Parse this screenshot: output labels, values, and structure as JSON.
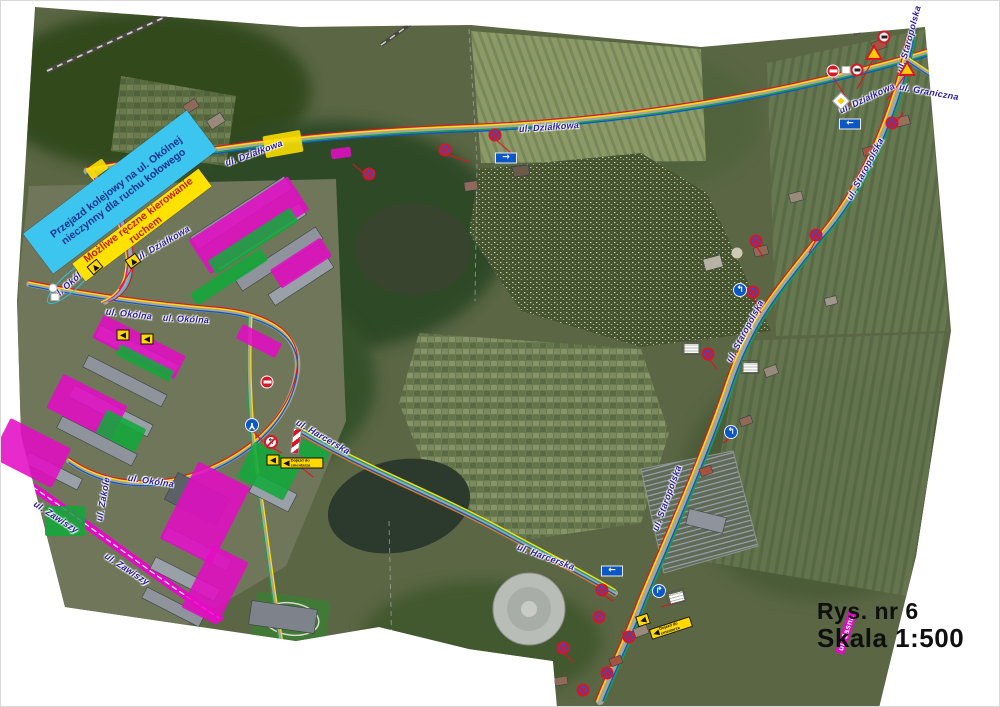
{
  "title_block": {
    "line1": "Rys. nr 6",
    "line2": "Skala 1:500"
  },
  "colors": {
    "magenta": "#e20cc4",
    "green": "#11a83a",
    "yellow": "#ffe000",
    "callout_cyan": "#3cc6ef",
    "callout_yellow": "#ffe200",
    "label_blue": "#2a1b9e",
    "sign_red": "#d81626",
    "sign_blue": "#0b57c8",
    "route_red": "#e01420"
  },
  "callouts": [
    {
      "text": "Przejazd kolejowy na ul. Okólnej nieczynny dla ruchu kołowego",
      "x": 119,
      "y": 191,
      "w": 205,
      "h": 50,
      "rot": -37,
      "bg": "#3cc6ef",
      "color": "#14328c"
    },
    {
      "text": "Możliwe ręczne kierowanie ruchem",
      "x": 141,
      "y": 224,
      "w": 158,
      "h": 22,
      "rot": -37,
      "bg": "#ffe200",
      "color": "#c41e10"
    }
  ],
  "street_labels": [
    {
      "text": "ul. Działkowa",
      "x": 253,
      "y": 152,
      "rot": -20
    },
    {
      "text": "ul. Działkowa",
      "x": 548,
      "y": 126,
      "rot": -4
    },
    {
      "text": "ul. Działkowa",
      "x": 866,
      "y": 97,
      "rot": -25
    },
    {
      "text": "ul. Działkowa",
      "x": 162,
      "y": 242,
      "rot": -30
    },
    {
      "text": "ul. Graniczna",
      "x": 928,
      "y": 91,
      "rot": 10
    },
    {
      "text": "ul. Staropolska",
      "x": 908,
      "y": 38,
      "rot": -75
    },
    {
      "text": "ul. Staropolska",
      "x": 864,
      "y": 168,
      "rot": -62
    },
    {
      "text": "ul. Staropolska",
      "x": 744,
      "y": 330,
      "rot": -62
    },
    {
      "text": "ul. Staropolska",
      "x": 666,
      "y": 497,
      "rot": -70
    },
    {
      "text": "ul. Harcerska",
      "x": 545,
      "y": 556,
      "rot": 20
    },
    {
      "text": "ul. Harcerska",
      "x": 322,
      "y": 436,
      "rot": 30
    },
    {
      "text": "ul. Okólna",
      "x": 128,
      "y": 313,
      "rot": 6
    },
    {
      "text": "ul. Okólna",
      "x": 185,
      "y": 318,
      "rot": 3
    },
    {
      "text": "ul. Okólna",
      "x": 150,
      "y": 480,
      "rot": 8
    },
    {
      "text": "ul. Okólna",
      "x": 70,
      "y": 281,
      "rot": -42,
      "variant": "circled"
    },
    {
      "text": "ul. Zawiszy",
      "x": 55,
      "y": 516,
      "rot": 33
    },
    {
      "text": "ul. Zawiszy",
      "x": 126,
      "y": 568,
      "rot": 33
    },
    {
      "text": "ul. Zakole",
      "x": 102,
      "y": 498,
      "rot": -80
    },
    {
      "text": "ul. Jasna",
      "x": 845,
      "y": 632,
      "rot": -72,
      "variant": "boxed"
    }
  ],
  "zones": [
    {
      "color": "magenta",
      "x": 248,
      "y": 224,
      "w": 118,
      "h": 40,
      "rot": -33
    },
    {
      "color": "magenta",
      "x": 300,
      "y": 262,
      "w": 60,
      "h": 22,
      "rot": -33
    },
    {
      "color": "magenta",
      "x": 138,
      "y": 346,
      "w": 92,
      "h": 26,
      "rot": 27
    },
    {
      "color": "magenta",
      "x": 86,
      "y": 406,
      "w": 72,
      "h": 38,
      "rot": 27
    },
    {
      "color": "magenta",
      "x": 30,
      "y": 452,
      "w": 68,
      "h": 44,
      "rot": 27
    },
    {
      "color": "magenta",
      "x": 204,
      "y": 512,
      "w": 58,
      "h": 86,
      "rot": 27
    },
    {
      "color": "magenta",
      "x": 214,
      "y": 584,
      "w": 40,
      "h": 70,
      "rot": 27
    },
    {
      "color": "magenta",
      "x": 258,
      "y": 340,
      "w": 44,
      "h": 16,
      "rot": 27
    },
    {
      "color": "magenta",
      "x": 340,
      "y": 152,
      "w": 20,
      "h": 10,
      "rot": -8
    },
    {
      "color": "green",
      "x": 252,
      "y": 240,
      "w": 98,
      "h": 16,
      "rot": -33
    },
    {
      "color": "green",
      "x": 228,
      "y": 276,
      "w": 84,
      "h": 14,
      "rot": -33
    },
    {
      "color": "green",
      "x": 144,
      "y": 362,
      "w": 60,
      "h": 12,
      "rot": 27
    },
    {
      "color": "green",
      "x": 120,
      "y": 430,
      "w": 44,
      "h": 26,
      "rot": 27
    },
    {
      "color": "green",
      "x": 268,
      "y": 470,
      "w": 52,
      "h": 40,
      "rot": 27
    },
    {
      "color": "green",
      "x": 312,
      "y": 452,
      "w": 30,
      "h": 16,
      "rot": 27
    },
    {
      "color": "green",
      "x": 64,
      "y": 520,
      "w": 40,
      "h": 30,
      "rot": 0
    },
    {
      "color": "yellow",
      "x": 282,
      "y": 143,
      "w": 38,
      "h": 22,
      "rot": -10
    },
    {
      "color": "yellow",
      "x": 96,
      "y": 168,
      "w": 20,
      "h": 12,
      "rot": -35
    }
  ],
  "signs": [
    {
      "type": "no-stopping",
      "x": 444,
      "y": 149
    },
    {
      "type": "no-stopping",
      "x": 368,
      "y": 173
    },
    {
      "type": "no-stopping",
      "x": 494,
      "y": 134
    },
    {
      "type": "no-stopping",
      "x": 752,
      "y": 291
    },
    {
      "type": "no-stopping",
      "x": 707,
      "y": 353
    },
    {
      "type": "no-stopping",
      "x": 601,
      "y": 589
    },
    {
      "type": "no-stopping",
      "x": 598,
      "y": 616
    },
    {
      "type": "no-stopping",
      "x": 628,
      "y": 636
    },
    {
      "type": "no-stopping",
      "x": 606,
      "y": 672
    },
    {
      "type": "no-stopping",
      "x": 562,
      "y": 647
    },
    {
      "type": "no-stopping",
      "x": 582,
      "y": 689
    },
    {
      "type": "no-stopping",
      "x": 891,
      "y": 122
    },
    {
      "type": "no-stopping",
      "x": 815,
      "y": 234
    },
    {
      "type": "no-stopping",
      "x": 755,
      "y": 240
    },
    {
      "type": "no-entry",
      "x": 832,
      "y": 70
    },
    {
      "type": "no-entry",
      "x": 266,
      "y": 381
    },
    {
      "type": "restriction",
      "x": 883,
      "y": 36
    },
    {
      "type": "restriction",
      "x": 856,
      "y": 69
    },
    {
      "type": "white-square",
      "x": 845,
      "y": 69
    },
    {
      "type": "white-square",
      "x": 54,
      "y": 296
    },
    {
      "type": "white-circle",
      "x": 52,
      "y": 287
    },
    {
      "type": "triangle",
      "x": 873,
      "y": 51
    },
    {
      "type": "triangle",
      "x": 906,
      "y": 67
    },
    {
      "type": "diamond",
      "x": 840,
      "y": 100,
      "rot": 45
    },
    {
      "type": "one-way",
      "x": 849,
      "y": 123,
      "glyph": "←"
    },
    {
      "type": "one-way",
      "x": 611,
      "y": 570,
      "glyph": "←"
    },
    {
      "type": "one-way",
      "x": 505,
      "y": 157,
      "glyph": "→"
    },
    {
      "type": "turn",
      "x": 658,
      "y": 590,
      "glyph": "↱"
    },
    {
      "type": "turn",
      "x": 739,
      "y": 289,
      "glyph": "↰"
    },
    {
      "type": "turn",
      "x": 730,
      "y": 431,
      "glyph": "↰"
    },
    {
      "type": "roundabout",
      "x": 251,
      "y": 424,
      "glyph": "Y",
      "rot": 180
    },
    {
      "type": "no-left",
      "x": 270,
      "y": 441,
      "glyph": "↰"
    },
    {
      "type": "barrier",
      "x": 295,
      "y": 440,
      "rot": 8
    },
    {
      "type": "board-y",
      "x": 132,
      "y": 260,
      "rot": -35,
      "glyph": "▲"
    },
    {
      "type": "board-y",
      "x": 94,
      "y": 266,
      "rot": -40,
      "glyph": "▲"
    },
    {
      "type": "board-y",
      "x": 122,
      "y": 334,
      "glyph": "◀"
    },
    {
      "type": "board-y",
      "x": 146,
      "y": 338,
      "glyph": "◀"
    },
    {
      "type": "board-y",
      "x": 272,
      "y": 459,
      "glyph": "◀"
    },
    {
      "type": "board-y",
      "x": 301,
      "y": 462,
      "glyph": "◀",
      "label": "Dojazd do cmentarza"
    },
    {
      "type": "board-y",
      "x": 642,
      "y": 619,
      "rot": -18,
      "glyph": "◀"
    },
    {
      "type": "board-y",
      "x": 670,
      "y": 627,
      "rot": -18,
      "glyph": "◀",
      "label": "Dojazd do cmentarza"
    },
    {
      "type": "board-w",
      "x": 675,
      "y": 596,
      "rot": -15
    },
    {
      "type": "board-w",
      "x": 690,
      "y": 347
    },
    {
      "type": "board-w",
      "x": 749,
      "y": 366
    }
  ],
  "buildings": [
    [
      240,
      212,
      112,
      15,
      -33,
      "#8f949c"
    ],
    [
      258,
      236,
      104,
      14,
      -33,
      "#9aa0a8"
    ],
    [
      278,
      258,
      96,
      14,
      -33,
      "#8f949c"
    ],
    [
      300,
      280,
      70,
      13,
      -33,
      "#9aa0a8"
    ],
    [
      136,
      350,
      88,
      13,
      27,
      "#9aa0a8"
    ],
    [
      124,
      380,
      88,
      13,
      27,
      "#8f949c"
    ],
    [
      110,
      410,
      88,
      13,
      27,
      "#9aa0a8"
    ],
    [
      96,
      440,
      84,
      13,
      27,
      "#8f949c"
    ],
    [
      52,
      470,
      60,
      12,
      27,
      "#9aa0a8"
    ],
    [
      196,
      498,
      58,
      30,
      27,
      "#5c6168"
    ],
    [
      272,
      492,
      44,
      20,
      27,
      "#9aa0a8"
    ],
    [
      196,
      548,
      72,
      13,
      27,
      "#8f949c"
    ],
    [
      184,
      578,
      72,
      13,
      27,
      "#9aa0a8"
    ],
    [
      172,
      606,
      64,
      12,
      27,
      "#8f949c"
    ],
    [
      282,
      616,
      66,
      24,
      8,
      "#7e838b"
    ],
    [
      705,
      520,
      38,
      16,
      14,
      "#8f949c"
    ],
    [
      878,
      44,
      14,
      9,
      -20,
      "#a5533f"
    ],
    [
      858,
      28,
      12,
      8,
      -20,
      "#8f6a58"
    ],
    [
      902,
      120,
      13,
      9,
      -15,
      "#98705c"
    ],
    [
      868,
      150,
      12,
      8,
      -15,
      "#a5533f"
    ],
    [
      795,
      196,
      13,
      9,
      -15,
      "#9a8a7a"
    ],
    [
      760,
      250,
      14,
      9,
      -15,
      "#8f6a58"
    ],
    [
      830,
      300,
      12,
      8,
      -15,
      "#a0988c"
    ],
    [
      770,
      370,
      13,
      9,
      -20,
      "#9a8a7a"
    ],
    [
      745,
      420,
      12,
      8,
      -20,
      "#8f6a58"
    ],
    [
      705,
      470,
      12,
      8,
      -20,
      "#a5533f"
    ],
    [
      640,
      630,
      14,
      9,
      -20,
      "#9a8a7a"
    ],
    [
      615,
      660,
      12,
      8,
      -20,
      "#a5533f"
    ],
    [
      560,
      680,
      13,
      8,
      -10,
      "#8f6a58"
    ],
    [
      215,
      120,
      16,
      10,
      -33,
      "#9a8a7a"
    ],
    [
      190,
      105,
      14,
      9,
      -33,
      "#8f6a58"
    ],
    [
      520,
      170,
      16,
      10,
      -8,
      "#6a5a4a"
    ],
    [
      470,
      185,
      13,
      9,
      -8,
      "#8f6a58"
    ],
    [
      712,
      262,
      18,
      12,
      -15,
      "#b8b2a4"
    ]
  ],
  "red_links": [
    [
      444,
      153,
      468,
      161
    ],
    [
      368,
      177,
      352,
      163
    ],
    [
      494,
      138,
      510,
      152
    ],
    [
      873,
      57,
      856,
      88
    ],
    [
      906,
      72,
      886,
      99
    ],
    [
      832,
      76,
      850,
      104
    ],
    [
      891,
      127,
      902,
      112
    ],
    [
      752,
      296,
      760,
      312
    ],
    [
      707,
      357,
      716,
      368
    ],
    [
      601,
      593,
      612,
      600
    ],
    [
      628,
      640,
      620,
      630
    ],
    [
      270,
      446,
      281,
      452
    ],
    [
      251,
      429,
      262,
      441
    ],
    [
      675,
      601,
      660,
      606
    ],
    [
      562,
      651,
      572,
      661
    ],
    [
      815,
      239,
      808,
      252
    ],
    [
      755,
      244,
      762,
      256
    ],
    [
      730,
      436,
      722,
      442
    ],
    [
      132,
      266,
      118,
      288
    ],
    [
      301,
      467,
      312,
      476
    ]
  ]
}
